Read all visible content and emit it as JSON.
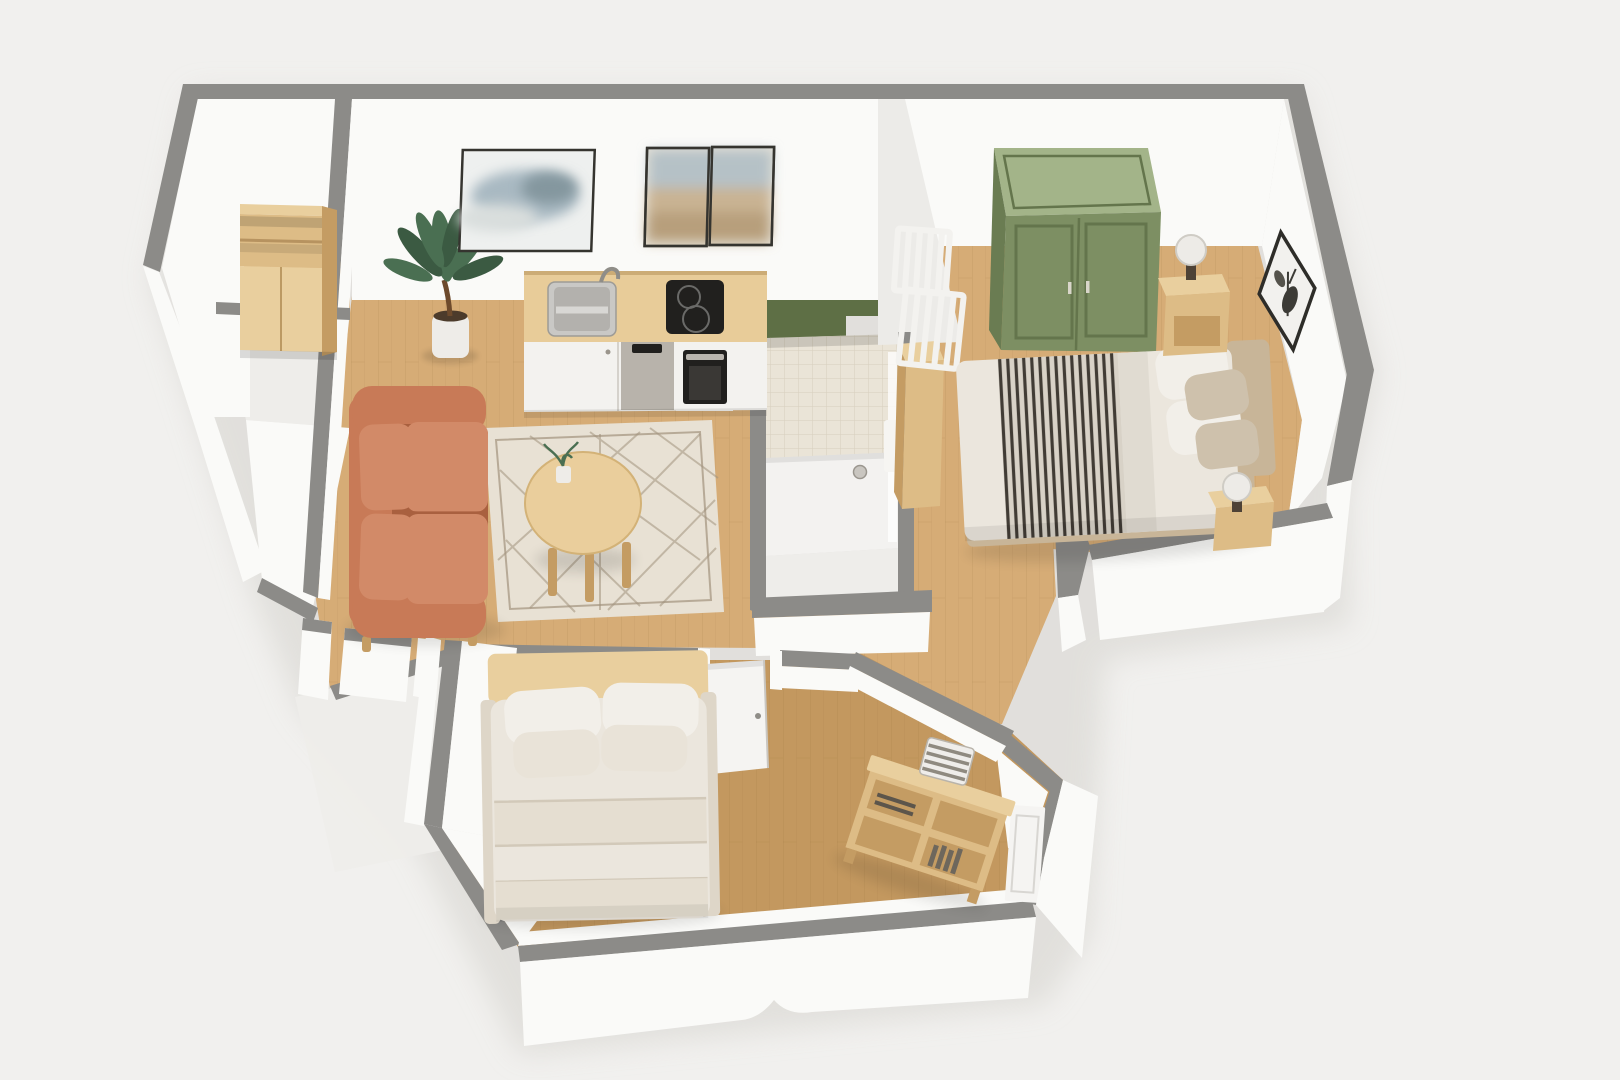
{
  "meta": {
    "content_kind": "3d-floor-plan-render",
    "view": "top-down dollhouse perspective",
    "text_on_screen": "none"
  },
  "palette": {
    "background": "#f1f0ee",
    "model_shadow": "#dcdad6",
    "wall_cap": "#8c8b88",
    "wall_face": "#fafaf8",
    "wall_face_shade": "#ecebe8",
    "wall_face_dark": "#dddbd7",
    "floor_wood": "#d6ac76",
    "floor_wood_dark": "#c3985f",
    "floor_white": "#eeedea",
    "plank_line": "#8a6233",
    "green_wall": "#5e6f45",
    "green_wardrobe": "#7d8f63",
    "green_wardrobe_top": "#a3b489",
    "green_wardrobe_line": "#64754c",
    "wood_light": "#e9cf9e",
    "wood_mid": "#ddbc86",
    "wood_dark": "#c49c63",
    "counter_top": "#e8cc99",
    "cabinet_white": "#f3f2ef",
    "steel": "#b8b3ab",
    "appliance_black": "#21201e",
    "sofa": "#c87a57",
    "sofa_light": "#d28a68",
    "sofa_dark": "#a9603f",
    "rug": "#e8e1d4",
    "rug_line": "#a2937e",
    "table_wood": "#eace9c",
    "bed_cream": "#ebe6dd",
    "bed_cream_deep": "#ded6c8",
    "pillow_white": "#f2efe9",
    "pillow_beige": "#cec1ac",
    "headboard_beige": "#c8b598",
    "stripe_base": "#d8d2c7",
    "stripe_dark": "#413c35",
    "tile": "#eae4d7",
    "tile_line": "#d7cfbd",
    "shower_tray": "#f3f2f0",
    "lamp_shade": "#edebe7",
    "lamp_base": "#4e4236",
    "art_frame": "#35342f",
    "art_sky": "#a9b9c2",
    "art_mist": "#84979f",
    "art_paper": "#e9e9e7",
    "art_sand": "#c9b393",
    "door_white": "#f5f4f2",
    "plant_green": "#4a6f52",
    "plant_green_dark": "#3b5a42",
    "pot_white": "#eeece8",
    "soil": "#4c3b2b",
    "book_dark": "#5c554b"
  },
  "scene": {
    "rooms": [
      {
        "id": "entry-hall",
        "floor": "wood",
        "furniture": [
          "storage-shelf-unit"
        ]
      },
      {
        "id": "closet-nook",
        "floor": "white",
        "furniture": []
      },
      {
        "id": "living-kitchen",
        "floor": "wood",
        "furniture": [
          "sofa",
          "coffee-table",
          "area-rug",
          "potted-plant",
          "wall-art-single",
          "wall-art-diptych",
          "kitchen-counter",
          "kitchen-sink",
          "faucet",
          "cooktop",
          "oven",
          "dishwasher",
          "green-accent-wall"
        ]
      },
      {
        "id": "bathroom",
        "floor": "shower-tray",
        "furniture": [
          "tiled-shower",
          "shower-drain",
          "tall-cabinet"
        ]
      },
      {
        "id": "main-bedroom",
        "floor": "wood",
        "furniture": [
          "wardrobe",
          "double-bed-striped",
          "nightstand-head",
          "nightstand-foot",
          "table-lamp-head",
          "table-lamp-foot",
          "diamond-wall-art",
          "stair-railing"
        ]
      },
      {
        "id": "hallway",
        "floor": "wood",
        "furniture": [
          "interior-door"
        ]
      },
      {
        "id": "second-bedroom",
        "floor": "wood",
        "furniture": [
          "bed-cream",
          "bookshelf-console",
          "storage-box",
          "books"
        ]
      }
    ]
  }
}
